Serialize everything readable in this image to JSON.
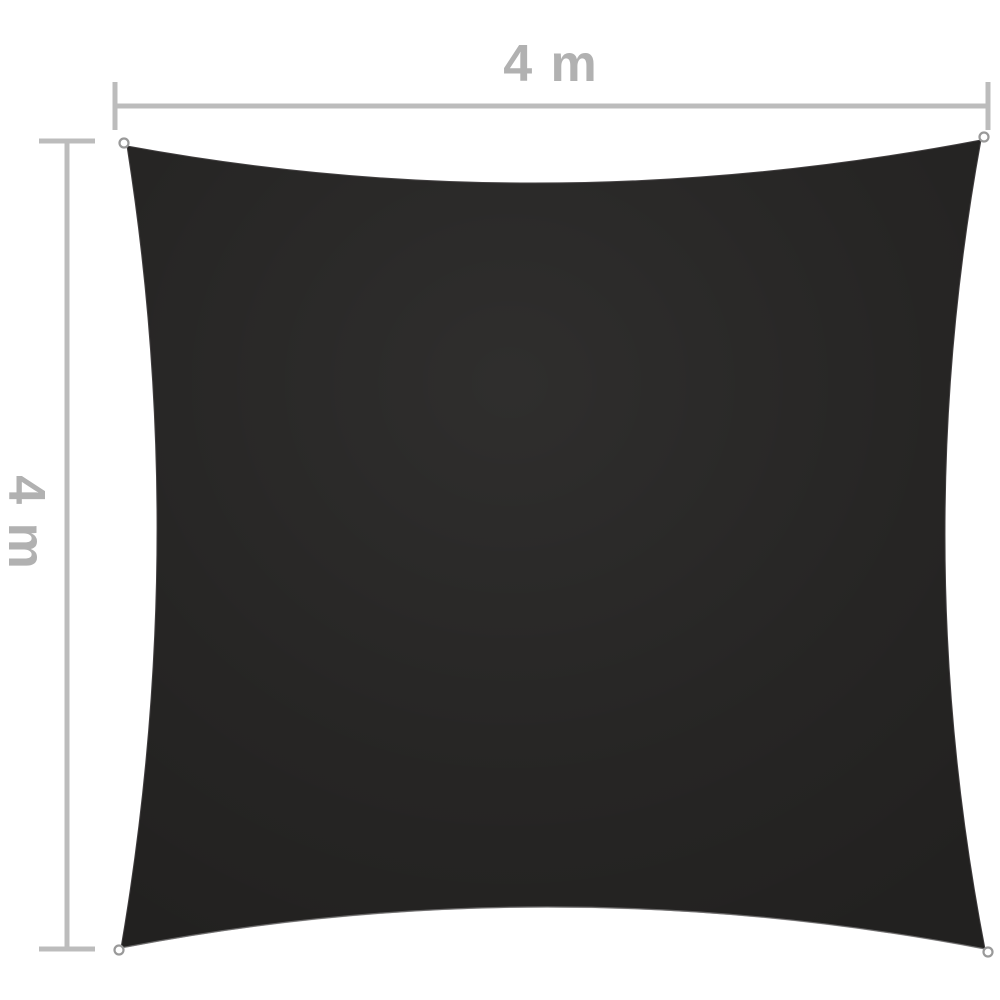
{
  "diagram": {
    "width_label": "4 m",
    "height_label": "4 m",
    "colors": {
      "background": "#ffffff",
      "sail": "#222120",
      "sail_edge": "#3f3c3d",
      "edge_highlight": "#9c9c9c",
      "dimension_line": "#bcbcbc",
      "label_text": "#b1b1b1",
      "grommet_ring": "#999999",
      "grommet_fill": "#ffffff"
    }
  }
}
